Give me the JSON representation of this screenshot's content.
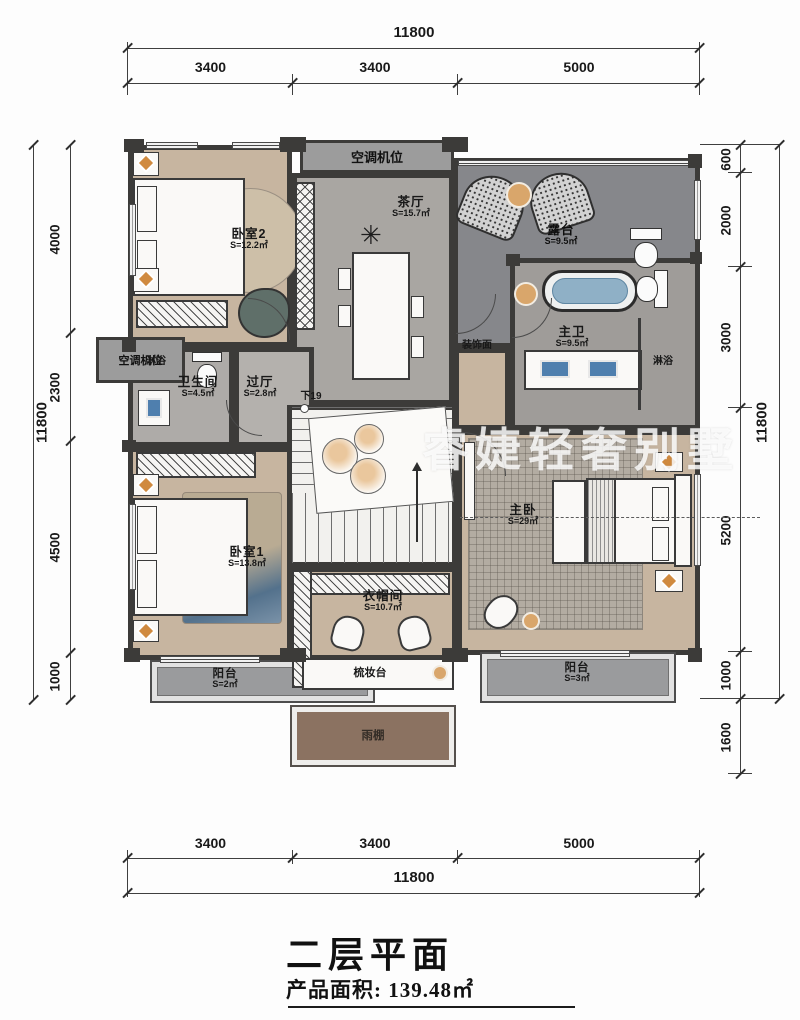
{
  "plan": {
    "watermark": "睿婕轻奢别墅",
    "title": "二层平面",
    "area_line": "产品面积: 139.48㎡"
  },
  "dims": {
    "top": {
      "total": "11800",
      "segments": [
        "3400",
        "3400",
        "5000"
      ]
    },
    "bottom": {
      "total": "11800",
      "segments": [
        "3400",
        "3400",
        "5000"
      ]
    },
    "left": {
      "total": "11800",
      "segments": [
        "4000",
        "2300",
        "4500",
        "1000"
      ]
    },
    "right": {
      "total": "11800",
      "segments": [
        "600",
        "2000",
        "3000",
        "5200",
        "1000",
        "1600"
      ]
    }
  },
  "rooms": {
    "bedroom2": {
      "name": "卧室2",
      "area": "S=12.2㎡"
    },
    "tea_hall": {
      "name": "茶厅",
      "area": "S=15.7㎡"
    },
    "terrace": {
      "name": "露台",
      "area": "S=9.5㎡"
    },
    "master_bath": {
      "name": "主卫",
      "area": "S=9.5㎡"
    },
    "bathroom": {
      "name": "卫生间",
      "area": "S=4.5㎡"
    },
    "hallway": {
      "name": "过厅",
      "area": "S=2.8㎡"
    },
    "bedroom1": {
      "name": "卧室1",
      "area": "S=13.8㎡"
    },
    "master_bedroom": {
      "name": "主卧",
      "area": "S=29㎡"
    },
    "cloakroom": {
      "name": "衣帽间",
      "area": "S=10.7㎡"
    },
    "balcony_left": {
      "name": "阳台",
      "area": "S=2㎡"
    },
    "balcony_right": {
      "name": "阳台",
      "area": "S=3㎡"
    }
  },
  "labels": {
    "ac_top": "空调机位",
    "ac_left": "空调机位",
    "shower_left": "淋浴",
    "shower_right": "淋浴",
    "decor_face": "装饰面",
    "stairs_down": "下19",
    "dresser": "梳妆台",
    "canopy": "雨棚"
  },
  "colors": {
    "wall": "#3c3b39",
    "wood_floor": "#c7b5a0",
    "marble": "#a9a6a2",
    "terrace": "#86878b",
    "balcony": "#9a9b9d",
    "canopy": "#8b7261",
    "accent_orange": "#d08a3f",
    "water_blue": "#8fb0c6",
    "watermark_white": "#ffffff"
  }
}
